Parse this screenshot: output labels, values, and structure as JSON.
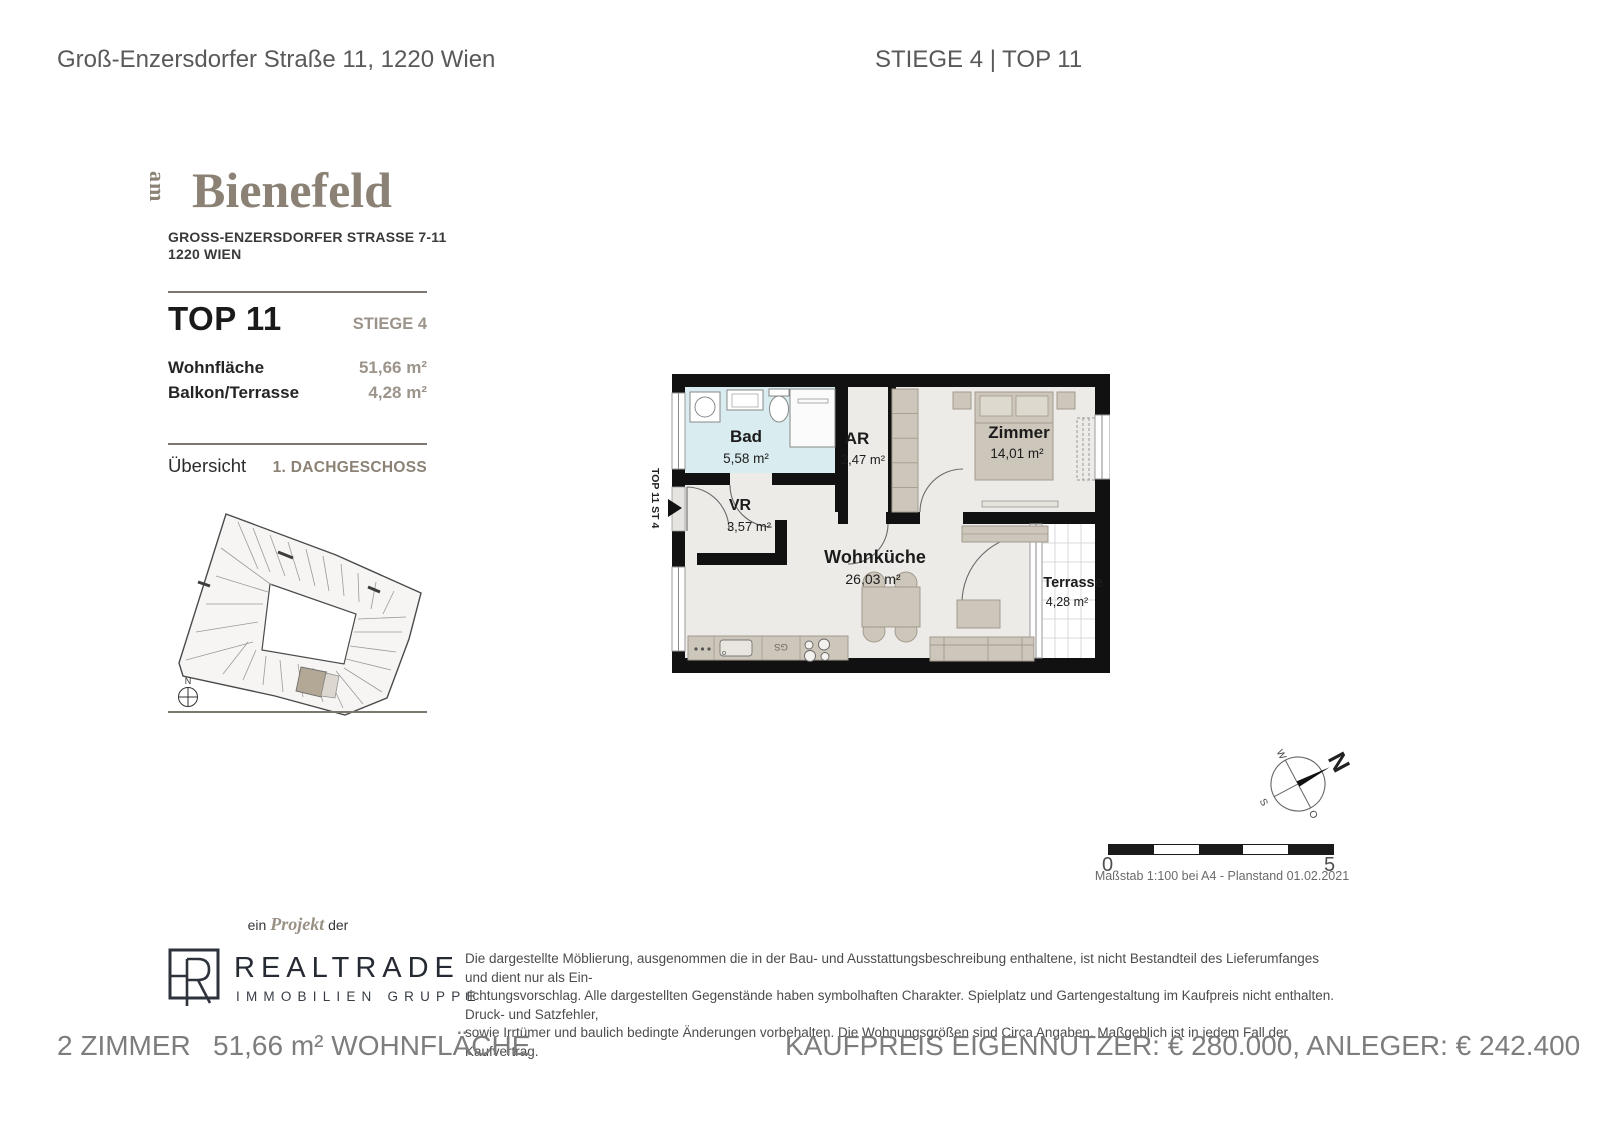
{
  "header": {
    "address": "Groß-Enzersdorfer Straße 11, 1220 Wien",
    "unit_ref": "STIEGE 4 | TOP 11"
  },
  "brand": {
    "logo_prefix": "am",
    "logo_name": "Bienefeld",
    "address_line1": "GROSS-ENZERSDORFER STRASSE 7-11",
    "address_line2": "1220 WIEN"
  },
  "unit": {
    "title": "TOP 11",
    "stiege": "STIEGE 4",
    "rows": [
      {
        "label": "Wohnfläche",
        "value": "51,66 m²"
      },
      {
        "label": "Balkon/Terrasse",
        "value": "4,28 m²"
      }
    ]
  },
  "overview": {
    "label": "Übersicht",
    "floor": "1. DACHGESCHOSS",
    "north_label": "N"
  },
  "floorplan": {
    "entrance_label": "TOP 11 ST 4",
    "kitchen_appliance_label": "GS",
    "rooms": [
      {
        "name": "Bad",
        "area": "5,58 m²"
      },
      {
        "name": "AR",
        "area": "2,47 m²"
      },
      {
        "name": "Zimmer",
        "area": "14,01 m²"
      },
      {
        "name": "VR",
        "area": "3,57 m²"
      },
      {
        "name": "Wohnküche",
        "area": "26,03 m²"
      },
      {
        "name": "Terrasse",
        "area": "4,28 m²"
      }
    ]
  },
  "compass": {
    "n": "N",
    "w": "W",
    "s": "S",
    "o": "O"
  },
  "scalebar": {
    "start": "0",
    "end": "5",
    "caption": "Maßstab 1:100 bei A4 - Planstand 01.02.2021"
  },
  "publisher": {
    "pre": "ein",
    "project": "Projekt",
    "post": "der",
    "name": "REALTRADE",
    "subtitle": "IMMOBILIEN GRUPPE"
  },
  "disclaimer": {
    "line1": "Die dargestellte Möblierung, ausgenommen die in der Bau- und Ausstattungsbeschreibung enthaltene, ist nicht Bestandteil des Lieferumfanges und dient nur als Ein-",
    "line2": "richtungsvorschlag. Alle dargestellten Gegenstände haben symbolhaften Charakter. Spielplatz und Gartengestaltung im Kaufpreis nicht enthalten. Druck- und Satzfehler,",
    "line3": "sowie Irrtümer und baulich bedingte Änderungen vorbehalten. Die Wohnungsgrößen sind Circa Angaben. Maßgeblich ist in jedem Fall der Kaufvertrag."
  },
  "footer": {
    "rooms": "2 ZIMMER",
    "area": "51,66 m² WOHNFLÄCHE",
    "price": "KAUFPREIS EIGENNUTZER: € 280.000, ANLEGER: € 242.400"
  },
  "colors": {
    "accent_taupe": "#8b8275",
    "wall_black": "#111111",
    "bad_floor": "#d9ecef",
    "furniture": "#cdc6ba"
  }
}
